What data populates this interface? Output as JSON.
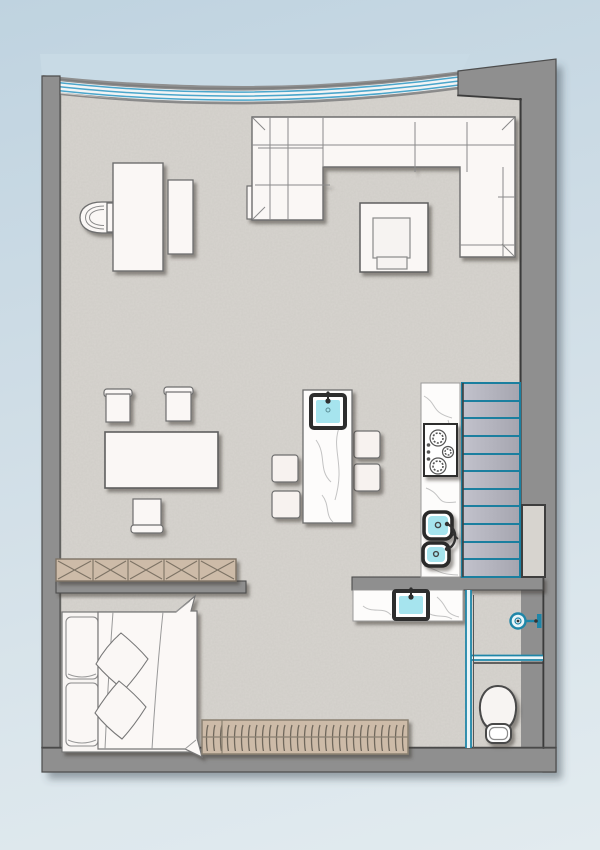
{
  "app": {
    "type": "architectural-floor-plan",
    "view": "top-down studio apartment plan",
    "visible_text": []
  },
  "palette": {
    "background_top": "#bfd3e0",
    "background_bottom": "#e2ebef",
    "wall_gray": "#8f8f8f",
    "wall_outline": "#4d4d4d",
    "floor_gray": "#d7d4cf",
    "furniture_white": "#faf7f5",
    "furniture_outline": "#6e6e6e",
    "glass_blue": "#4ba6cb",
    "partition_blue": "#1f86a8",
    "stair_teal": "#1b7f9f",
    "stair_tread_light": "#bfbfc9",
    "stair_tread_dark": "#a7a7b1",
    "water_cyan": "#a6e4ee",
    "fixture_dark": "#2e2e2e",
    "wood_tan": "#cdbba8",
    "wood_outline": "#7d7365",
    "marble_vein": "#c3c3c3"
  },
  "counts": {
    "stair_treads": 11,
    "bar_stools": 4,
    "dining_chairs": 3,
    "sink_basins": 4,
    "cooktop_burners": 3,
    "wardrobe_x_cells": 5,
    "glass_facade_mullions": 3,
    "bed_pillows": 2,
    "bed_cushions": 2
  },
  "furniture": [
    {
      "name": "curved-glass-facade",
      "label": "curved glazed window wall, top"
    },
    {
      "name": "desk",
      "label": "desk with half-round chair and side cabinet"
    },
    {
      "name": "sectional-sofa",
      "label": "U-shaped sectional sofa with ottoman"
    },
    {
      "name": "coffee-table",
      "label": "square coffee table"
    },
    {
      "name": "dining-table",
      "label": "dining table with three chairs"
    },
    {
      "name": "kitchen-island",
      "label": "marble island with sink and four bar stools"
    },
    {
      "name": "kitchen-counter",
      "label": "marble counter with cooktop and double sink"
    },
    {
      "name": "staircase",
      "label": "straight stair, teal nosing lines"
    },
    {
      "name": "wall-niche",
      "label": "recessed niche in right wall"
    },
    {
      "name": "wardrobe-crossed",
      "label": "low cabinet with X-front, 5 cells"
    },
    {
      "name": "bed",
      "label": "double bed with pillows, cushions and blanket"
    },
    {
      "name": "hanger-bench",
      "label": "wardrobe rail with hangers along bottom wall"
    },
    {
      "name": "vanity",
      "label": "bathroom vanity with basin"
    },
    {
      "name": "glass-partition",
      "label": "blue glass partitions of bathroom"
    },
    {
      "name": "shower-head",
      "label": "wall-mounted shower symbol"
    },
    {
      "name": "toilet",
      "label": "toilet, bottom-right room"
    }
  ]
}
